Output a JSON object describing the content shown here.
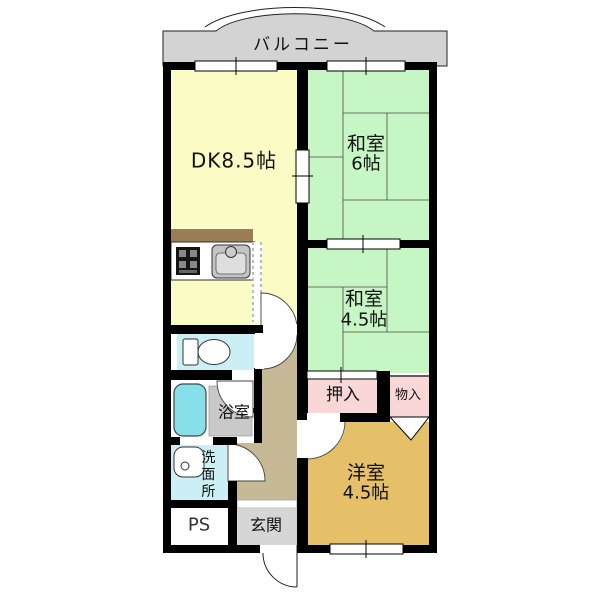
{
  "plan_title": "apartment-floor-plan",
  "colors": {
    "wall": "#000000",
    "balcony": "#D3D3D3",
    "dining_kitchen": "#FBFBC6",
    "tatami_room": "#C6F6C3",
    "closet": "#FAD7D7",
    "western_room": "#E5C068",
    "water_area": "#CBEFF4",
    "bathtub": "#87DFEA",
    "shower_floor": "#C9C9C9",
    "hallway": "#C6B995",
    "entrance": "#D6D6D6",
    "kitchen_counter": "#9A7C55"
  },
  "rooms": [
    {
      "id": "balcony",
      "label": "バルコニー"
    },
    {
      "id": "dining-kitchen",
      "label": "DK8.5帖"
    },
    {
      "id": "washitsu-6",
      "label": "和室",
      "size": "6帖"
    },
    {
      "id": "washitsu-4-5",
      "label": "和室",
      "size": "4.5帖"
    },
    {
      "id": "oshiire-closet",
      "label": "押入"
    },
    {
      "id": "monoire-storage",
      "label": "物入"
    },
    {
      "id": "youshitsu-4-5",
      "label": "洋室",
      "size": "4.5帖"
    },
    {
      "id": "bathroom",
      "label": "浴室"
    },
    {
      "id": "washroom",
      "label": "洗面所"
    },
    {
      "id": "pipe-space",
      "label": "PS"
    },
    {
      "id": "entrance-hall",
      "label": "玄関"
    }
  ],
  "fixtures": [
    "stove-icon",
    "kitchen-sink-icon",
    "toilet-icon",
    "bathtub-icon",
    "washbasin-icon",
    "door-swing-arc",
    "sliding-door",
    "window",
    "entrance-door"
  ]
}
